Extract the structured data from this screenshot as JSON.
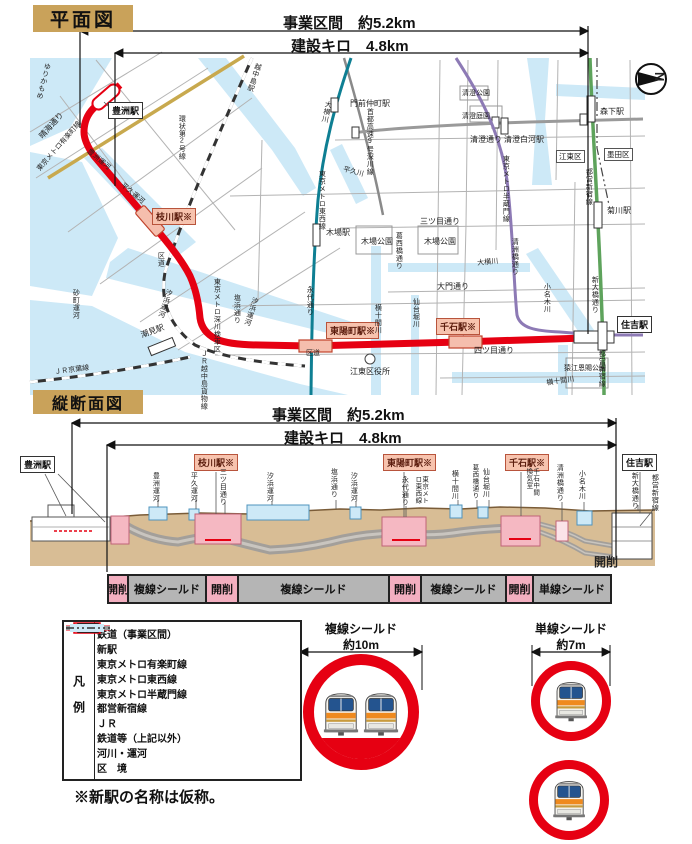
{
  "colors": {
    "project_red": "#e60012",
    "new_station_pink": "#f5bead",
    "yurakucho_gold": "#c8a94e",
    "tozai_teal": "#0e7f93",
    "hanzomon_purple": "#8d7ab5",
    "shinjuku_green": "#5ea35c",
    "jr_black": "#333333",
    "other_rail_gray": "#9a9a9a",
    "water_blue": "#cde9f7",
    "ground_tan": "#d8bd95",
    "title_tan": "#c9a25a",
    "cut_pink": "#f3afc0",
    "shield_gray": "#b5b5b5"
  },
  "plan": {
    "title": "平面図",
    "dim_business": "事業区間　約5.2km",
    "dim_construction": "建設キロ　4.8km",
    "compass_label": "N",
    "stations": {
      "toyosu": "豊洲駅",
      "edagawa": "枝川駅※",
      "toyocho": "東陽町駅※",
      "sengoku": "千石駅※",
      "sumiyoshi": "住吉駅",
      "monzennakacho": "門前仲町駅",
      "etchujima": "越中島駅",
      "kiba": "木場駅",
      "shiomi": "潮見駅",
      "kiyosumi_shirakawa": "清澄白河駅",
      "morishita": "森下駅",
      "kikukawa": "菊川駅"
    },
    "labels": {
      "yurikamome": "ゆりかもめ",
      "harumi_dori": "晴海通り",
      "yurakucho_line": "東京メトロ有楽町線",
      "kanjo_2": "環状第2号線",
      "toyosu_canal": "豊洲運河",
      "heikyu_canal": "平久運河",
      "heikyu_river": "平久川",
      "oyokogawa": "大横川",
      "shuto_exp": "首都高速9号深川線",
      "tozai_line": "東京メトロ東西線",
      "eitai_dori": "永代通り",
      "kudo": "区道",
      "shiohama_canal": "汐浜運河",
      "shiohama_dori": "塩浜通り",
      "fukagawa_depot": "東京メトロ深川検車区",
      "sunamachi_canal": "砂町運河",
      "keiyo_line": "ＪＲ京葉線",
      "etchujima_freight": "ＪＲ越中島貨物線",
      "mitsume_dori": "三ツ目通り",
      "kiba_park": "木場公園",
      "daimon_dori": "大門通り",
      "yotsume_dori": "四ツ目通り",
      "koto_ward_office": "江東区役所",
      "sendaibori_river": "仙台堀川",
      "yokojikken_river": "横十間川",
      "onagi_river": "小名木川",
      "kiyosubashi_dori": "清洲橋通り",
      "kiyosumi_dori": "清澄通り",
      "kiyosumi_park": "清澄公園",
      "kiyosumi_garden": "清澄庭園",
      "hanzomon_line": "東京メトロ半蔵門線",
      "shinjuku_line": "都営新宿線",
      "shin_ohashi_dori": "新大橋通り",
      "sarue_park": "猿江恩賜公園",
      "kasaibashi_dori": "葛西橋通り",
      "koto_ward": "江東区",
      "sumida_ward": "墨田区"
    }
  },
  "profile": {
    "title": "縦断面図",
    "dim_business": "事業区間　約5.2km",
    "dim_construction": "建設キロ　4.8km",
    "kaisaku": "開削",
    "stations": {
      "toyosu": "豊洲駅",
      "edagawa": "枝川駅※",
      "toyocho": "東陽町駅※",
      "sengoku": "千石駅※",
      "sumiyoshi": "住吉駅"
    },
    "labels": {
      "toyosu_canal": "豊洲運河",
      "heikyu_canal": "平久運河",
      "mitsume_dori": "三ツ目通り",
      "shiohama_canal": "汐浜運河",
      "shiohama_dori": "塩浜通り",
      "eitai_dori": "永代通り",
      "tozai_line": "東京メトロ東西線",
      "yokojikken_river": "横十間川",
      "kasaibashi_dori": "葛西橋通り",
      "sendaibori_river": "仙台堀川",
      "sengoku_vent": "千石中間換気室",
      "kiyosubashi_dori": "清洲橋通り",
      "onagi_river": "小名木川",
      "shin_ohashi_dori": "新大橋通り",
      "shinjuku_line": "都営新宿線"
    }
  },
  "construction_bar": {
    "segments": [
      {
        "label": "開削",
        "type": "cut"
      },
      {
        "label": "複線シールド",
        "type": "shield"
      },
      {
        "label": "開削",
        "type": "cut"
      },
      {
        "label": "複線シールド",
        "type": "shield"
      },
      {
        "label": "開削",
        "type": "cut"
      },
      {
        "label": "複線シールド",
        "type": "shield"
      },
      {
        "label": "開削",
        "type": "cut"
      },
      {
        "label": "単線シールド",
        "type": "shield"
      }
    ]
  },
  "legend": {
    "title": "凡例",
    "items": [
      {
        "label": "鉄道（事業区間）"
      },
      {
        "label": "新駅"
      },
      {
        "label": "東京メトロ有楽町線"
      },
      {
        "label": "東京メトロ東西線"
      },
      {
        "label": "東京メトロ半蔵門線"
      },
      {
        "label": "都営新宿線"
      },
      {
        "label": "ＪＲ"
      },
      {
        "label": "鉄道等（上記以外）"
      },
      {
        "label": "河川・運河"
      },
      {
        "label": "区　境"
      }
    ]
  },
  "cross_sections": {
    "double": {
      "title": "複線シールド",
      "size": "約10m"
    },
    "single": {
      "title": "単線シールド",
      "size": "約7m"
    }
  },
  "note": "※新駅の名称は仮称。"
}
